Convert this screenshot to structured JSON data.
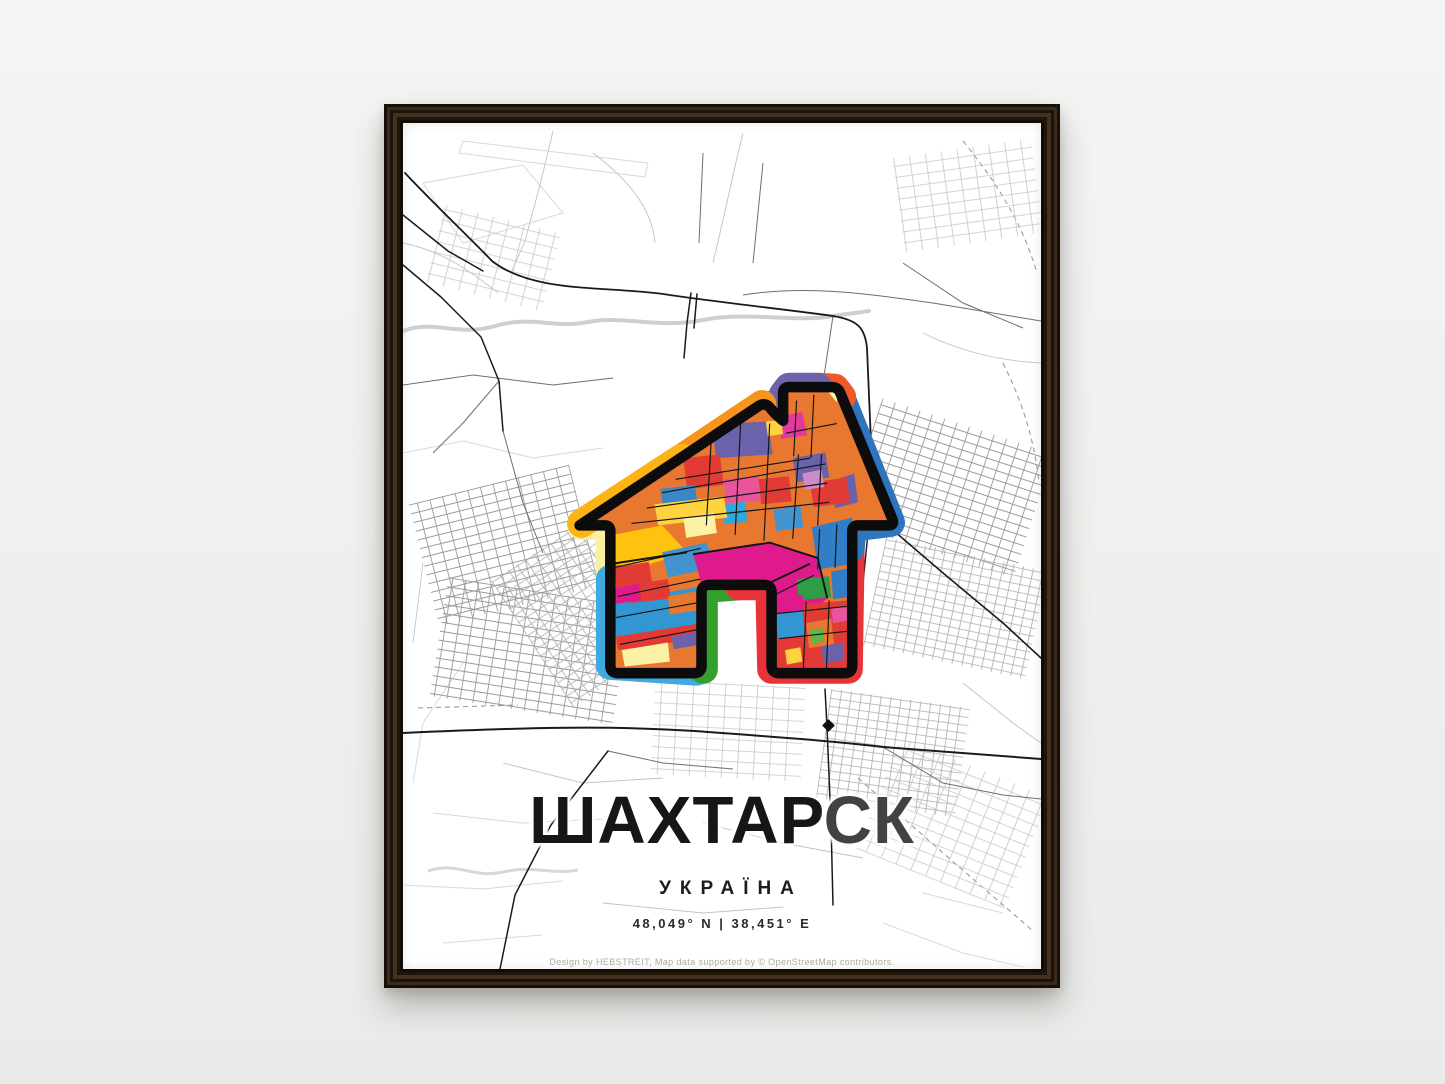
{
  "poster": {
    "title_primary": "ШАХТАР",
    "title_secondary": "СК",
    "subtitle": "УКРАЇНА",
    "coordinates": "48,049° N | 38,451° E",
    "credit": "Design by HEBSTREIT, Map data supported by © OpenStreetMap contributors.",
    "frame_color": "#2a1d11",
    "icon": {
      "name": "house-map-icon",
      "border_colors": {
        "left_wall": "#F8EFA3",
        "left_roof": "#FCB316",
        "peak_notch": "#6B63AC",
        "chimney_corner": "#F0582C",
        "right_roof": "#2E75BB",
        "right_wall_bottom": "#E8333B",
        "notch_inner_left": "#33A02C",
        "left_leg_bottom": "#3FA9E0"
      },
      "fill_colors": [
        "#E8772F",
        "#DE1A8C",
        "#E23B36",
        "#3196D2",
        "#2F7EC7",
        "#6A62AB",
        "#FFC20E",
        "#FFD23F",
        "#FBF2A5",
        "#2E9E44",
        "#E8559C",
        "#CE8BC8",
        "#56B948"
      ]
    }
  }
}
